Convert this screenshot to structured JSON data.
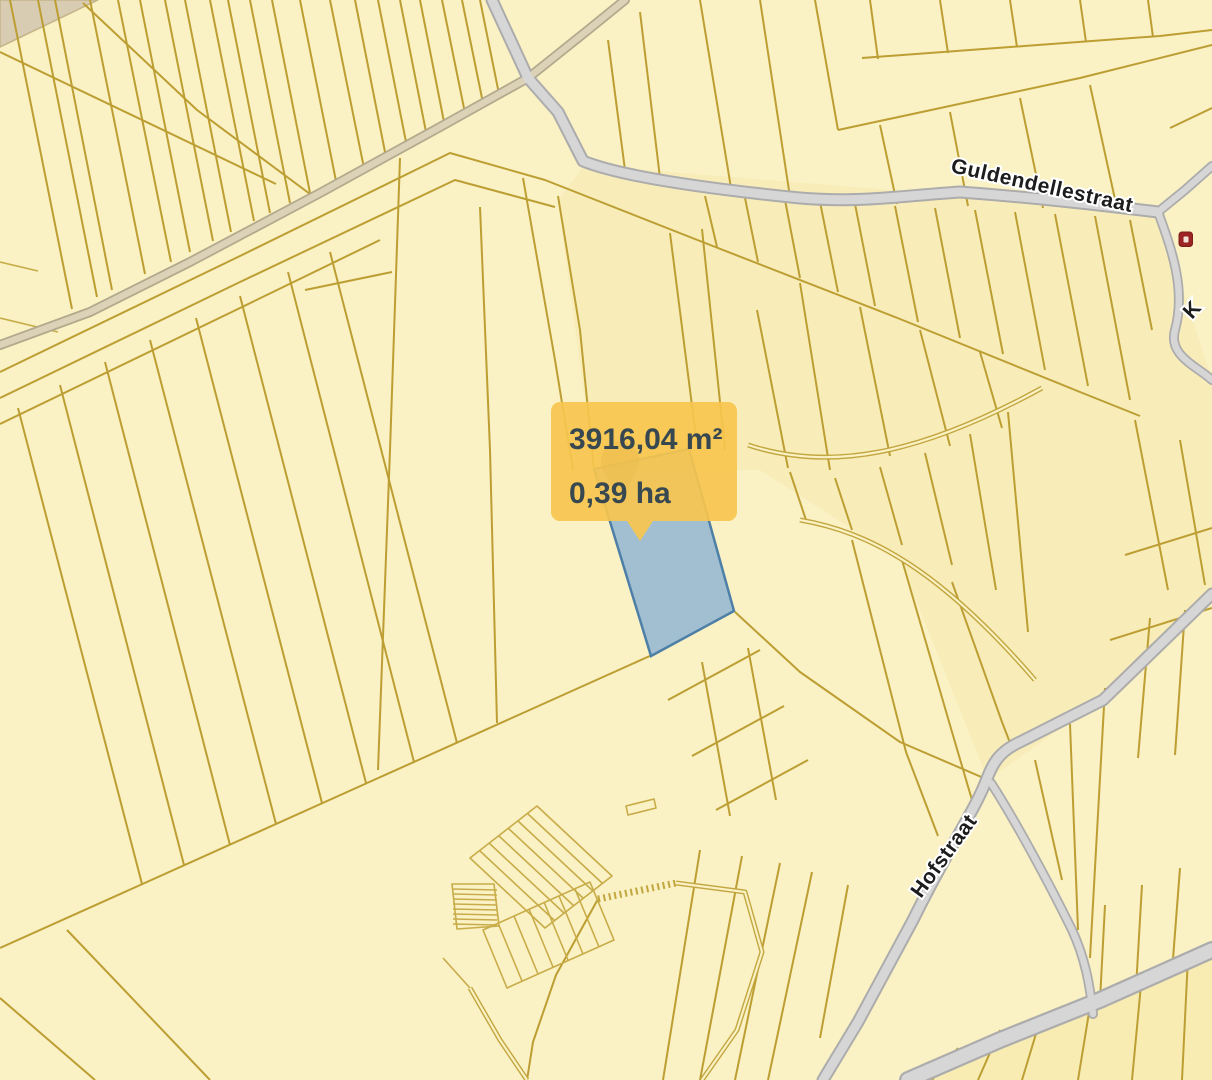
{
  "map": {
    "tooltip": {
      "area_m2": "3916,04 m²",
      "area_ha": "0,39 ha"
    },
    "street_labels": {
      "main": "Guldendellestraat",
      "secondary": "Hofstraat",
      "partial_right_edge": "K"
    },
    "highlighted_parcel": {
      "area_m2": "3916,04 m²",
      "area_ha": "0,39 ha",
      "fill": "#8FB3D4",
      "border": "#4E80A7"
    },
    "colors": {
      "parcel_fill": "#FAF1C4",
      "parcel_border": "#BC9E33",
      "road_fill": "#D6D6D6",
      "road_casing": "#ACACAC",
      "track_fill": "#DBD2B8",
      "outside_area_fill": "#D8CCB2",
      "tooltip_background": "#F7C54E",
      "tooltip_text": "#384850",
      "street_label_text": "#1D1D1D",
      "poi_icon_color": "#9B2323"
    },
    "icons": {
      "marker": "map-pin-icon",
      "poi": "poi-building-icon"
    }
  }
}
